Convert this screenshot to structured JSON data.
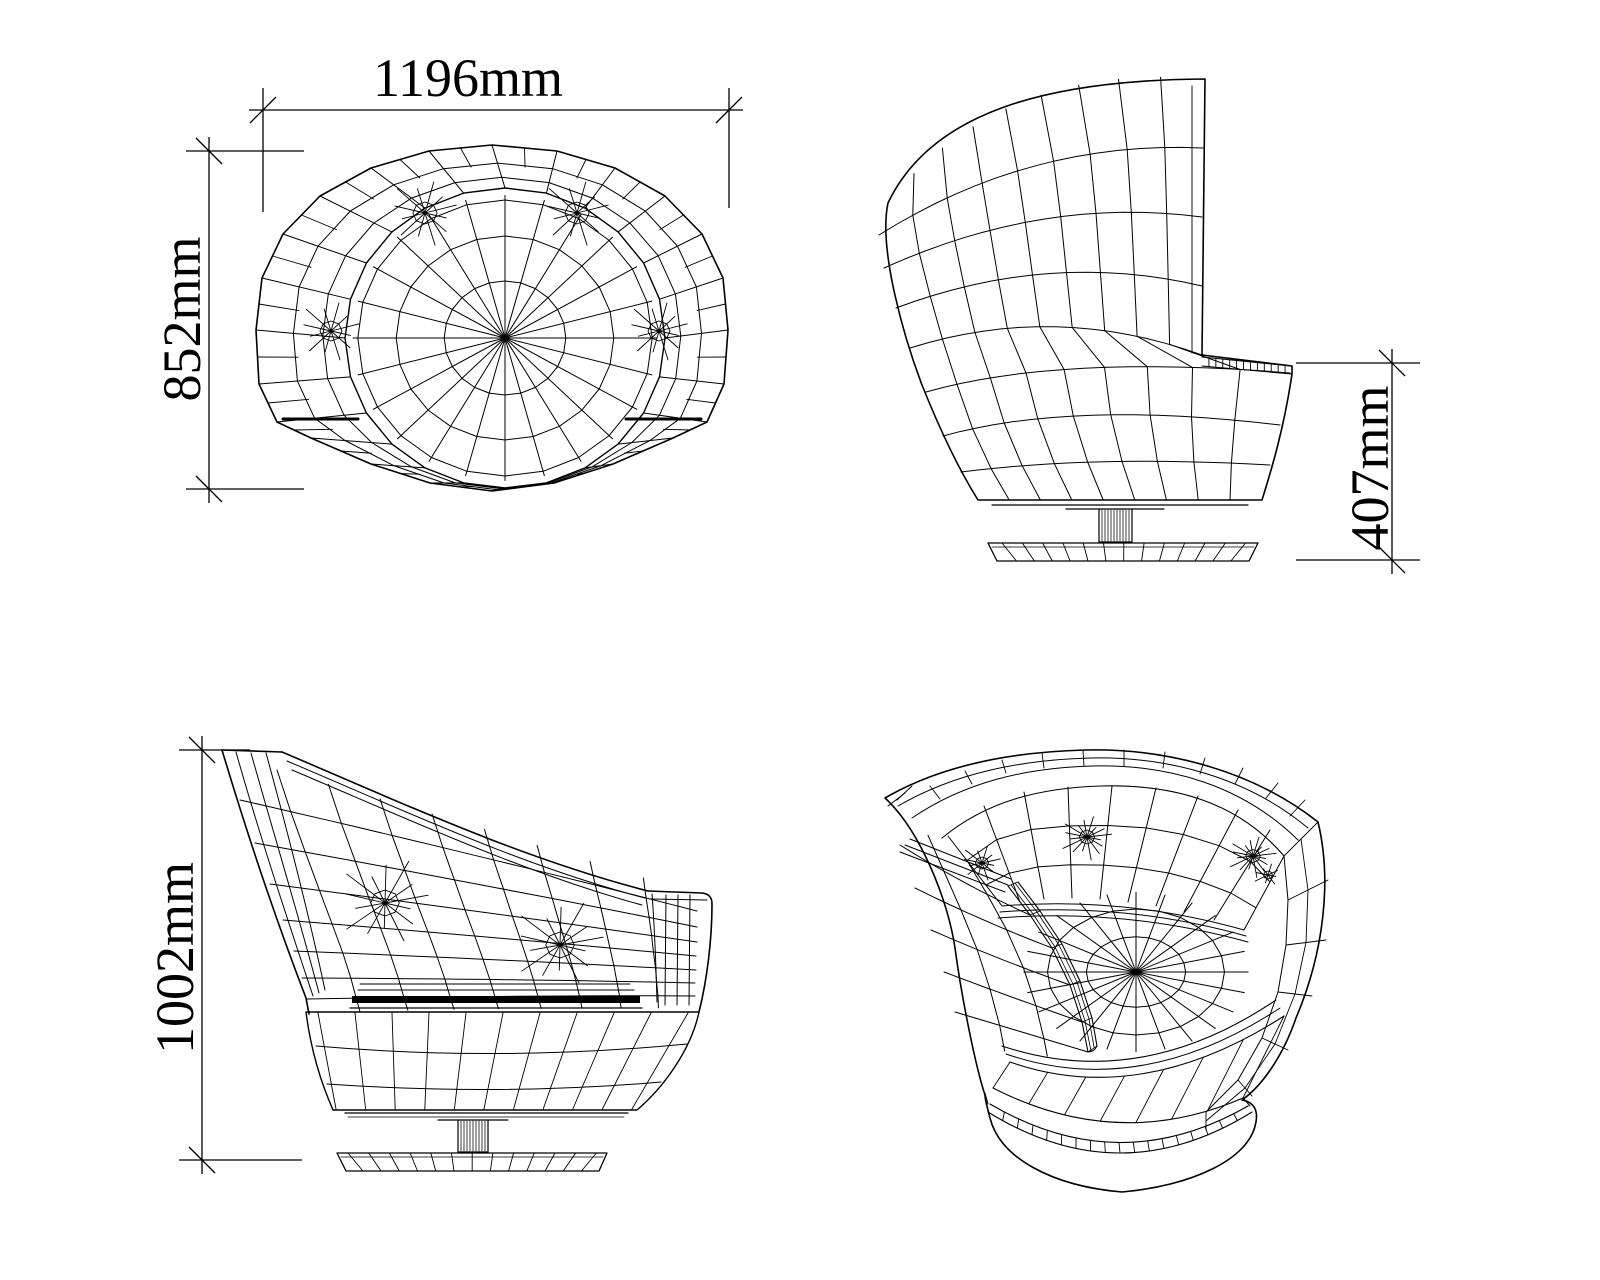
{
  "sheet": {
    "background": "#ffffff",
    "line_color": "#000000",
    "content": "wireframe CAD drawing of a swivel tub armchair in four views"
  },
  "dimensions": {
    "width": {
      "label": "1196mm",
      "value_mm": 1196,
      "orientation": "horizontal",
      "attached_view": "top-view"
    },
    "depth": {
      "label": "852mm",
      "value_mm": 852,
      "orientation": "vertical",
      "attached_view": "top-view"
    },
    "seat_height": {
      "label": "407mm",
      "value_mm": 407,
      "orientation": "vertical",
      "attached_view": "side-view-facing-left"
    },
    "overall_height": {
      "label": "1002mm",
      "value_mm": 1002,
      "orientation": "vertical",
      "attached_view": "side-view-facing-right"
    }
  }
}
